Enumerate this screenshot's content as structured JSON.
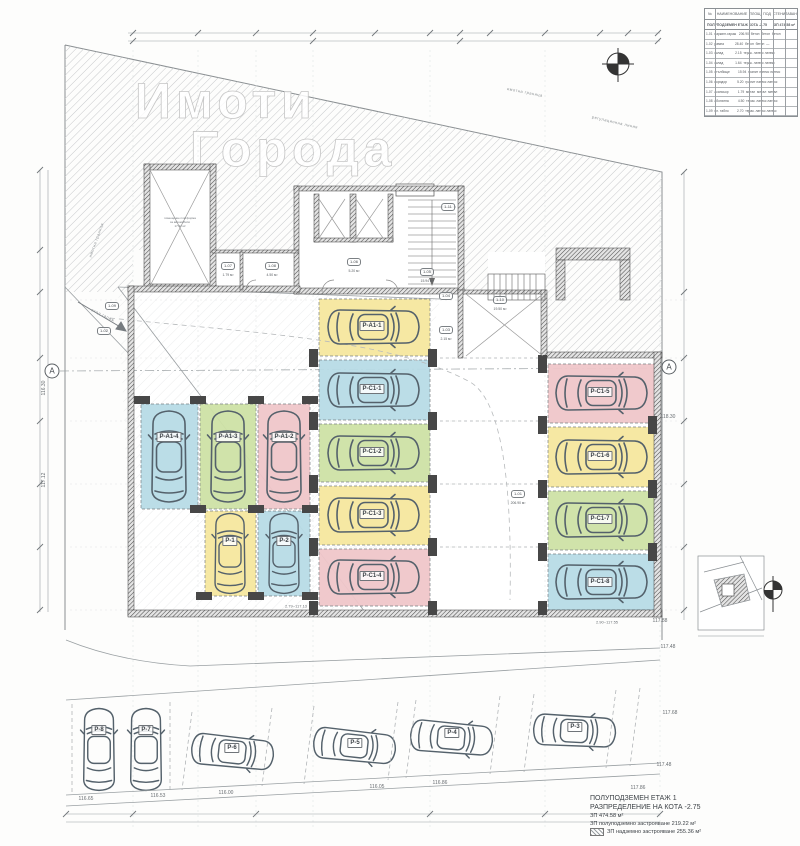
{
  "watermark": {
    "line1": "Имоти",
    "line2": "Города"
  },
  "grid_axis": {
    "label": "А"
  },
  "stalls": [
    {
      "label": "P-A1-4",
      "color": "#b7dbe6"
    },
    {
      "label": "P-A1-3",
      "color": "#cde2a5"
    },
    {
      "label": "P-A1-2",
      "color": "#efc6c9"
    },
    {
      "label": "P-1",
      "color": "#f6e79e"
    },
    {
      "label": "P-2",
      "color": "#b7dbe6"
    },
    {
      "label": "P-A1-1",
      "color": "#f6e79e"
    },
    {
      "label": "P-C1-1",
      "color": "#b7dbe6"
    },
    {
      "label": "P-C1-2",
      "color": "#cde2a5"
    },
    {
      "label": "P-C1-3",
      "color": "#f6e79e"
    },
    {
      "label": "P-C1-4",
      "color": "#efc6c9"
    },
    {
      "label": "P-C1-5",
      "color": "#efc6c9"
    },
    {
      "label": "P-C1-6",
      "color": "#f6e79e"
    },
    {
      "label": "P-C1-7",
      "color": "#cde2a5"
    },
    {
      "label": "P-C1-8",
      "color": "#b7dbe6"
    },
    {
      "label": "P-8"
    },
    {
      "label": "P-7"
    },
    {
      "label": "P-6"
    },
    {
      "label": "P-5"
    },
    {
      "label": "P-4"
    },
    {
      "label": "P-3"
    }
  ],
  "rooms": [
    {
      "tag": "1-01",
      "area": "206.90 м²"
    },
    {
      "tag": "1-02",
      "area": ""
    },
    {
      "tag": "1-03",
      "area": "2.15 м²"
    },
    {
      "tag": "1-04",
      "area": "1.64 м²"
    },
    {
      "tag": "1-05",
      "area": "15.94 м²"
    },
    {
      "tag": "1-06",
      "area": "5.20 м²"
    },
    {
      "tag": "1-07",
      "area": "1.79 м²"
    },
    {
      "tag": "1-08",
      "area": "4.50 м²"
    },
    {
      "tag": "1-09",
      "area": "2.70 м²"
    },
    {
      "tag": "1-10",
      "area": "19.50 м²"
    },
    {
      "tag": "1-11",
      "area": ""
    }
  ],
  "shaft_note": {
    "line1": "помещение платформа",
    "line2": "за автомобили",
    "line3": "17.02 м²"
  },
  "boundary_labels": {
    "top1": "имотна граница",
    "top2": "регулационна линия",
    "left": "имотна граница",
    "entrance": "вход гараж"
  },
  "elevations": {
    "e0": "118.30",
    "e1": "117.88",
    "e2": "117.48",
    "e3": "117.68",
    "e4": "117.48",
    "e5": "117.86",
    "e6": "116.65",
    "e7": "116.53",
    "e8": "116.00",
    "e9": "116.05",
    "e10": "116.86",
    "e11": "2.90~117.55",
    "e12": "2.79~117.13",
    "e13": "117.12",
    "e14": "116.30"
  },
  "title_block": {
    "headers": [
      "№",
      "НАИМЕНОВАНИЕ",
      "ПЛОЩ",
      "ПОД",
      "СТЕНИ",
      "ТАВАН"
    ],
    "subtitle_left": "ПОЛУПОДЗЕМЕН ЕТАЖ КОТА -2.75",
    "subtitle_right": "ЗП 474.58 м²",
    "rows": [
      "1-01  паркинг-гараж   206.90  бетон  бетон  бетон",
      "1-02  рампа            28.40  бетон  бетон  —",
      "1-03  склад             2.15  терак. латекс латекс",
      "1-04  склад             1.64  терак. латекс латекс",
      "1-05  стълбище         15.94  гранит латекс латекс",
      "1-06  коридор           5.20  гранит латекс латекс",
      "1-07  асансьор          1.79  метал  метал  метал",
      "1-08  абонатна          4.50  терак. латекс латекс",
      "1-09  ел. табло         2.70  терак. латекс латекс"
    ]
  },
  "legend": {
    "line1": "ПОЛУПОДЗЕМЕН ЕТАЖ 1",
    "line2": "РАЗПРЕДЕЛЕНИЕ НА КОТА -2.75",
    "line3": "ЗП 474.58 м²",
    "line4": "ЗП полуподземно застрояване 219.22 м²",
    "line5": "ЗП надземно застрояване 255.36 м²"
  }
}
